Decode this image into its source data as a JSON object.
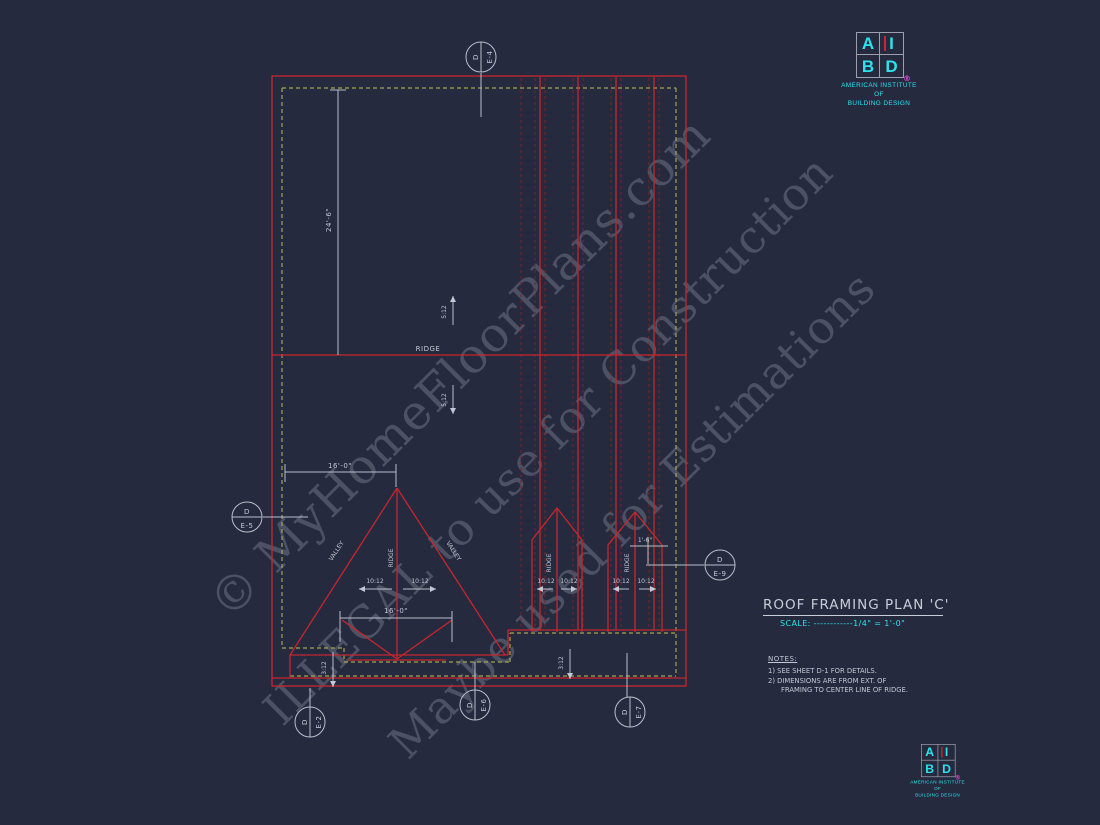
{
  "watermarks": {
    "line1": "© MyHomeFloorPlans.com",
    "line2": "ILLEGAL to use for Construction",
    "line3": "Maybe used for Estimations"
  },
  "logo": {
    "letter_a": "A",
    "letter_i": "I",
    "letter_b": "B",
    "letter_d": "D",
    "registered": "®",
    "org_line1": "AMERICAN INSTITUTE",
    "org_line2": "OF",
    "org_line3": "BUILDING DESIGN"
  },
  "title_block": {
    "title": "ROOF FRAMING PLAN 'C'",
    "scale": "SCALE: ------------1/4\" = 1'-0\""
  },
  "notes": {
    "heading": "NOTES:",
    "note1": "1)  SEE SHEET D-1 FOR DETAILS.",
    "note2a": "2)  DIMENSIONS ARE FROM EXT. OF",
    "note2b": "FRAMING TO CENTER LINE OF RIDGE."
  },
  "plan": {
    "ridge_label": "RIDGE",
    "triangle_ridge_label": "RIDGE",
    "gable1_ridge_label": "RIDGE",
    "gable2_ridge_label": "RIDGE",
    "valley_left_label": "VALLEY",
    "valley_right_label": "VALLEY",
    "dim_height": "24'-6\"",
    "dim_width_upper": "16'-0\"",
    "dim_width_lower": "16'-0\"",
    "dim_gable": "1'-6\"",
    "slope_upper": "5:12",
    "slope_lower": "5:12",
    "slope_tri_left": "10:12",
    "slope_tri_right": "10:12",
    "slope_g1_left": "10:12",
    "slope_g1_right": "10:12",
    "slope_g2_left": "10:12",
    "slope_g2_right": "10:12",
    "slope_bottom_left": "3:12",
    "slope_bottom_mid": "3:12"
  },
  "callouts": {
    "top": {
      "detail": "D",
      "sheet": "E-4"
    },
    "left": {
      "detail": "D",
      "sheet": "E-5"
    },
    "right": {
      "detail": "D",
      "sheet": "E-9"
    },
    "bottom_left": {
      "detail": "D",
      "sheet": "E-2"
    },
    "bottom_mid": {
      "detail": "D",
      "sheet": "E-6"
    },
    "bottom_right": {
      "detail": "D",
      "sheet": "E-7"
    }
  },
  "colors": {
    "background": "#252a3f",
    "line_red": "#c8262e",
    "line_red_dim": "#7c2128",
    "line_dash_yellow": "#a5a452",
    "line_gray": "#b9bfca",
    "text_cyan": "#2be2ee",
    "accent_magenta": "#d24fd2"
  }
}
